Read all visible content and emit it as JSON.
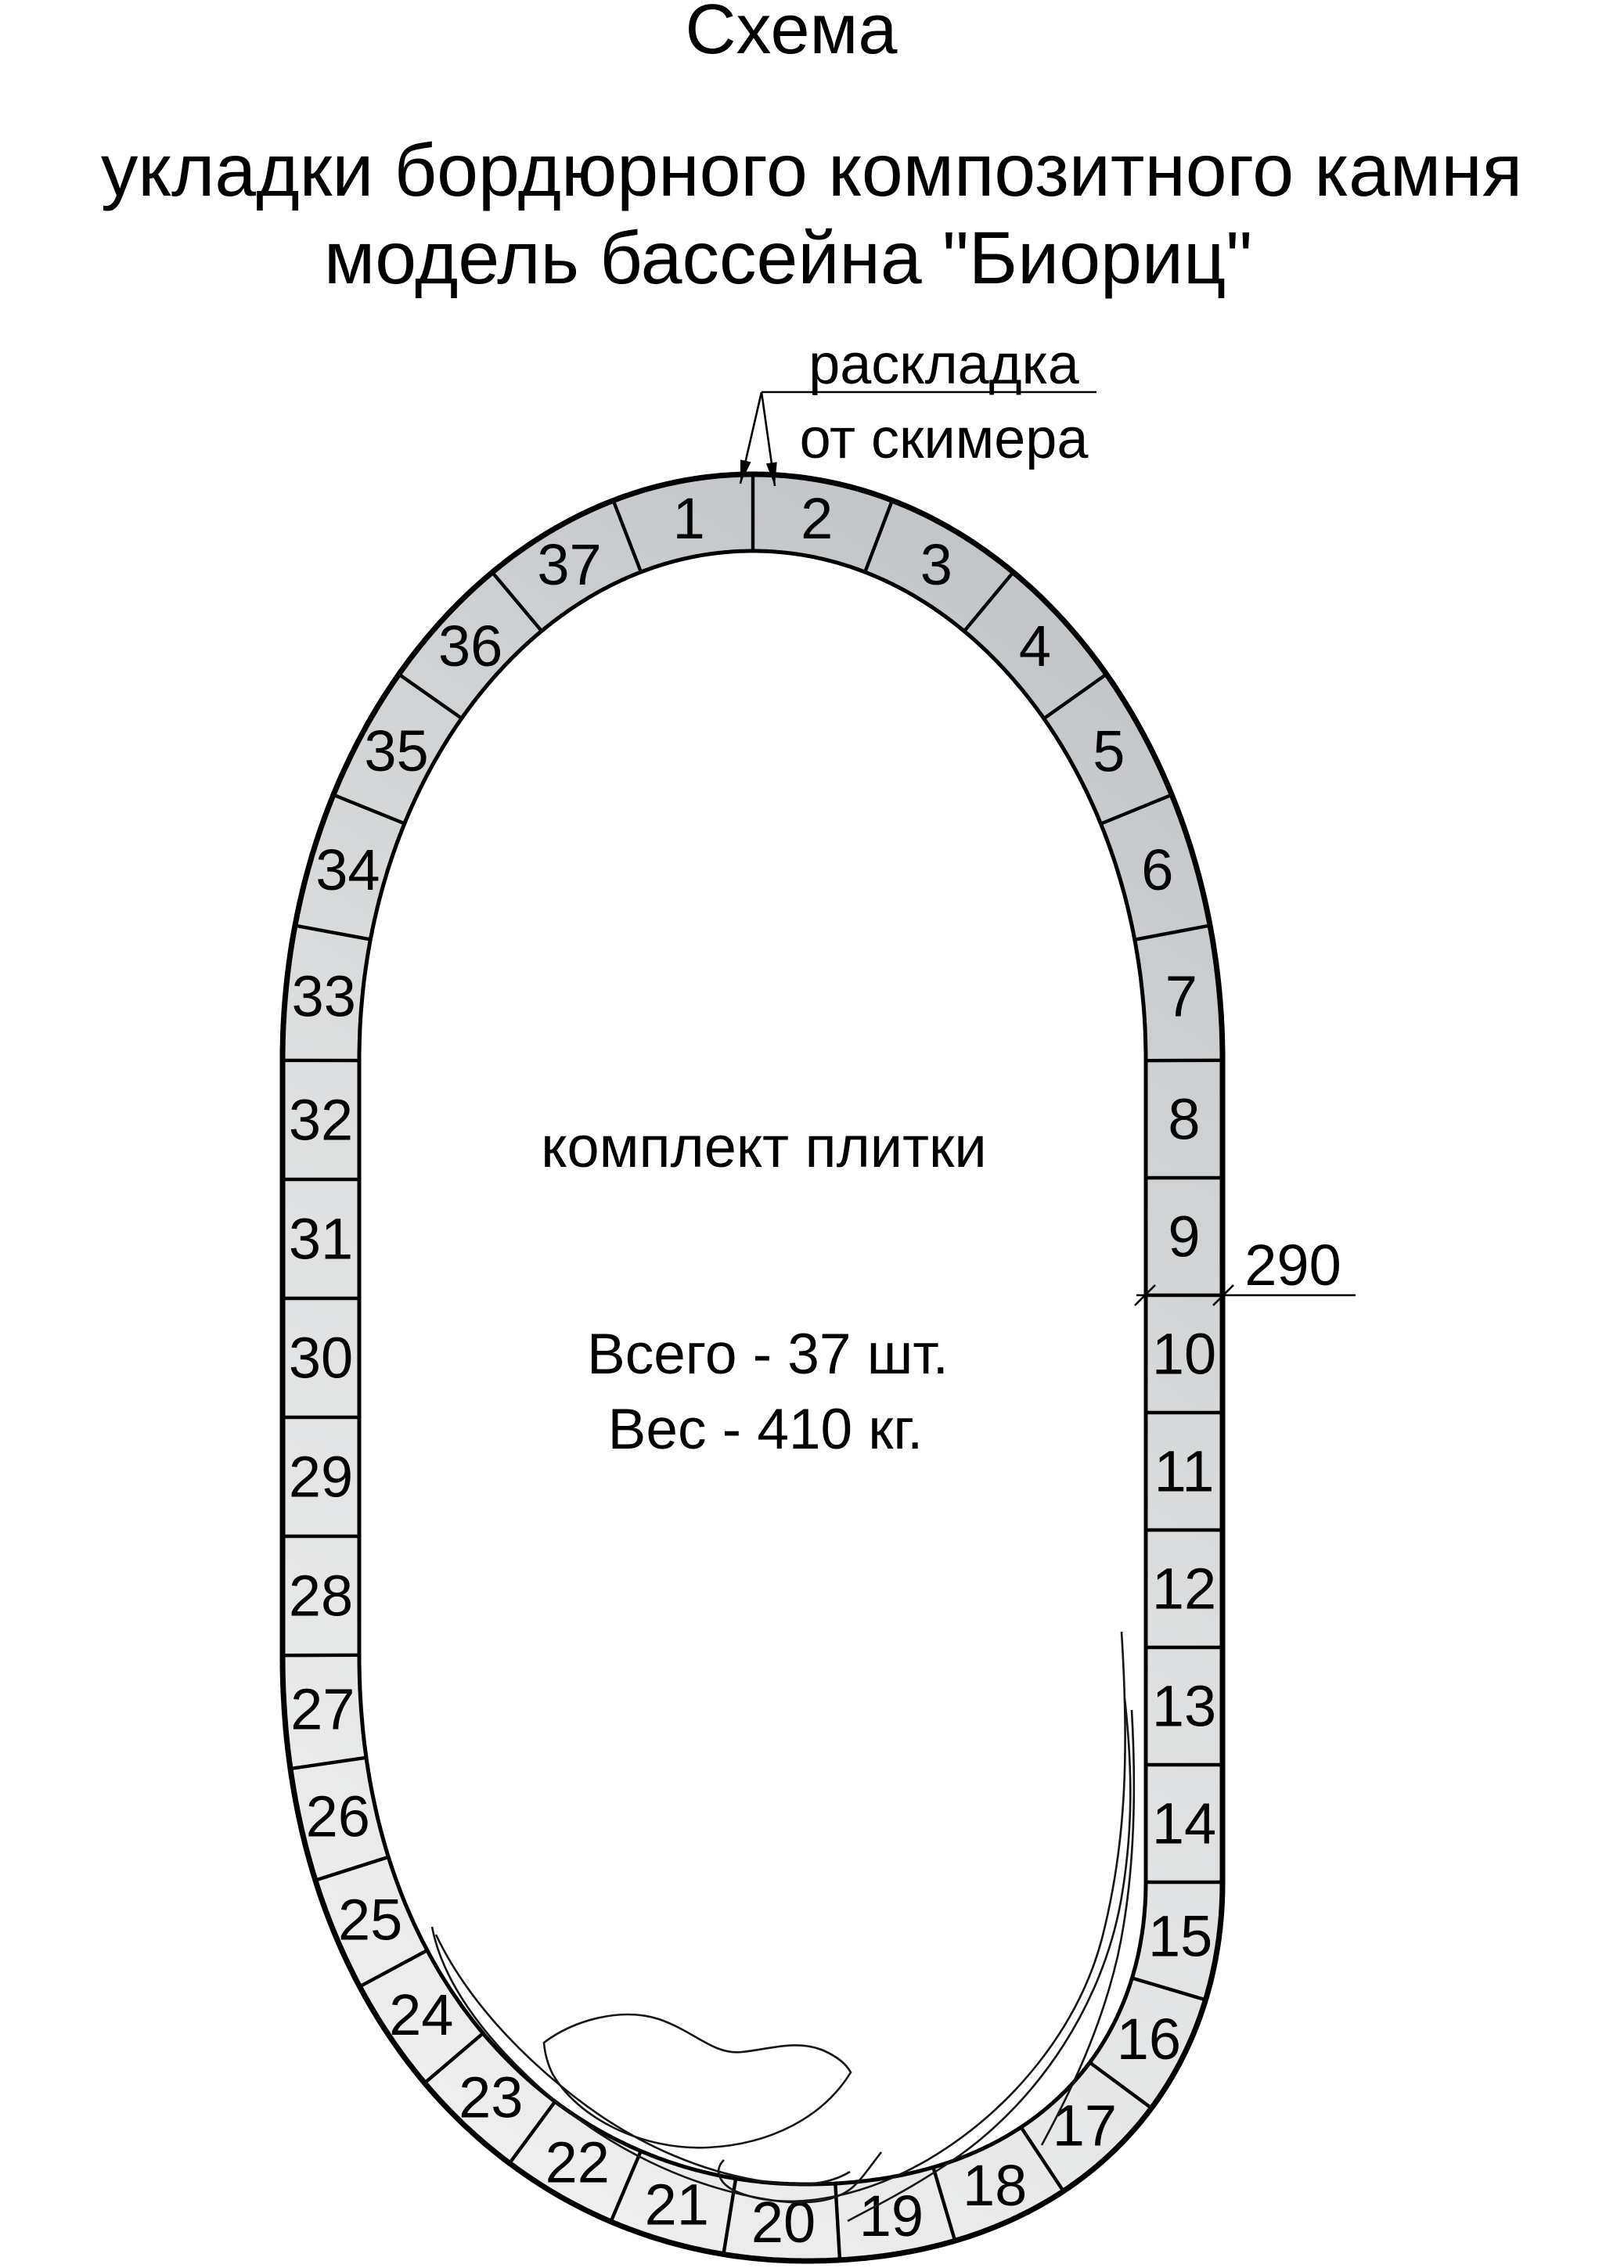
{
  "header": {
    "title": "Схема",
    "subtitle1": "укладки бордюрного композитного камня",
    "subtitle2": "модель бассейна \"Биориц\""
  },
  "annotations": {
    "skimmer": {
      "line1": "раскладка",
      "line2": "от скимера"
    },
    "dimension": {
      "value": "290"
    }
  },
  "center_note": {
    "line1": "комплект плитки",
    "line2": "Всего - 37 шт.",
    "line3": "Вес - 410 кг."
  },
  "tiles": [
    "1",
    "2",
    "3",
    "4",
    "5",
    "6",
    "7",
    "8",
    "9",
    "10",
    "11",
    "12",
    "13",
    "14",
    "15",
    "16",
    "17",
    "18",
    "19",
    "20",
    "21",
    "22",
    "23",
    "24",
    "25",
    "26",
    "27",
    "28",
    "29",
    "30",
    "31",
    "32",
    "33",
    "34",
    "35",
    "36",
    "37"
  ],
  "colors": {
    "background": "#ffffff",
    "band_light": "#eeeeee",
    "band_mid": "#dcdedf",
    "band_dark": "#c2c5c8",
    "line": "#000000"
  }
}
